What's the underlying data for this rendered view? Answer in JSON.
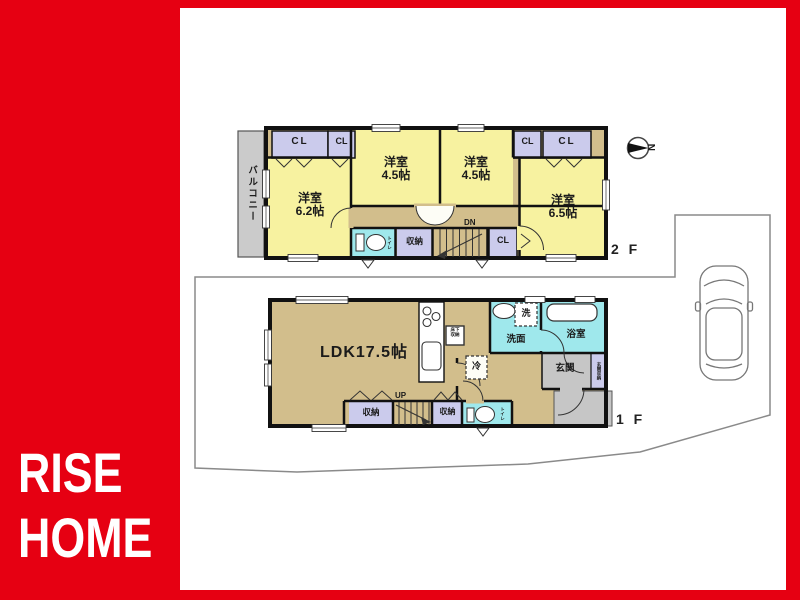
{
  "brand": {
    "line1": "RISE",
    "line2": "HOME",
    "brand_red": "#e60012"
  },
  "compass": {
    "label": "N"
  },
  "colors": {
    "room_yellow": "#f7f2a0",
    "hall_tan": "#d2be8c",
    "wet_cyan": "#9fe8ec",
    "closet_purple": "#cbcbec",
    "balcony_gray": "#cbcbcb",
    "wall_black": "#111111"
  },
  "floor2": {
    "floor_label": "2 F",
    "balcony_label": "バルコニー",
    "cl_labels": [
      "CL",
      "CL",
      "CL",
      "CL",
      "CL"
    ],
    "rooms": {
      "west_bedroom": {
        "name": "洋室",
        "size": "6.2帖"
      },
      "center_bedroom": {
        "name": "洋室",
        "size": "4.5帖"
      },
      "east_bedroom": {
        "name": "洋室",
        "size": "4.5帖"
      },
      "southeast_bedroom": {
        "name": "洋室",
        "size": "6.5帖"
      }
    },
    "storage_label": "収納",
    "toilet_label": "トイレ",
    "stairs_label": "DN"
  },
  "floor1": {
    "floor_label": "1 F",
    "ldk_label": "LDK17.5帖",
    "underfloor_storage": {
      "line1": "床下",
      "line2": "収納"
    },
    "refrigerator_label": "冷",
    "washer_label": "洗",
    "washroom_label": "洗面",
    "bathroom_label": "浴室",
    "entrance_label": "玄関",
    "entrance_storage_label": "玄関収納",
    "storage_labels": [
      "収納",
      "収納"
    ],
    "toilet_label": "トイレ",
    "stairs_label": "UP"
  }
}
